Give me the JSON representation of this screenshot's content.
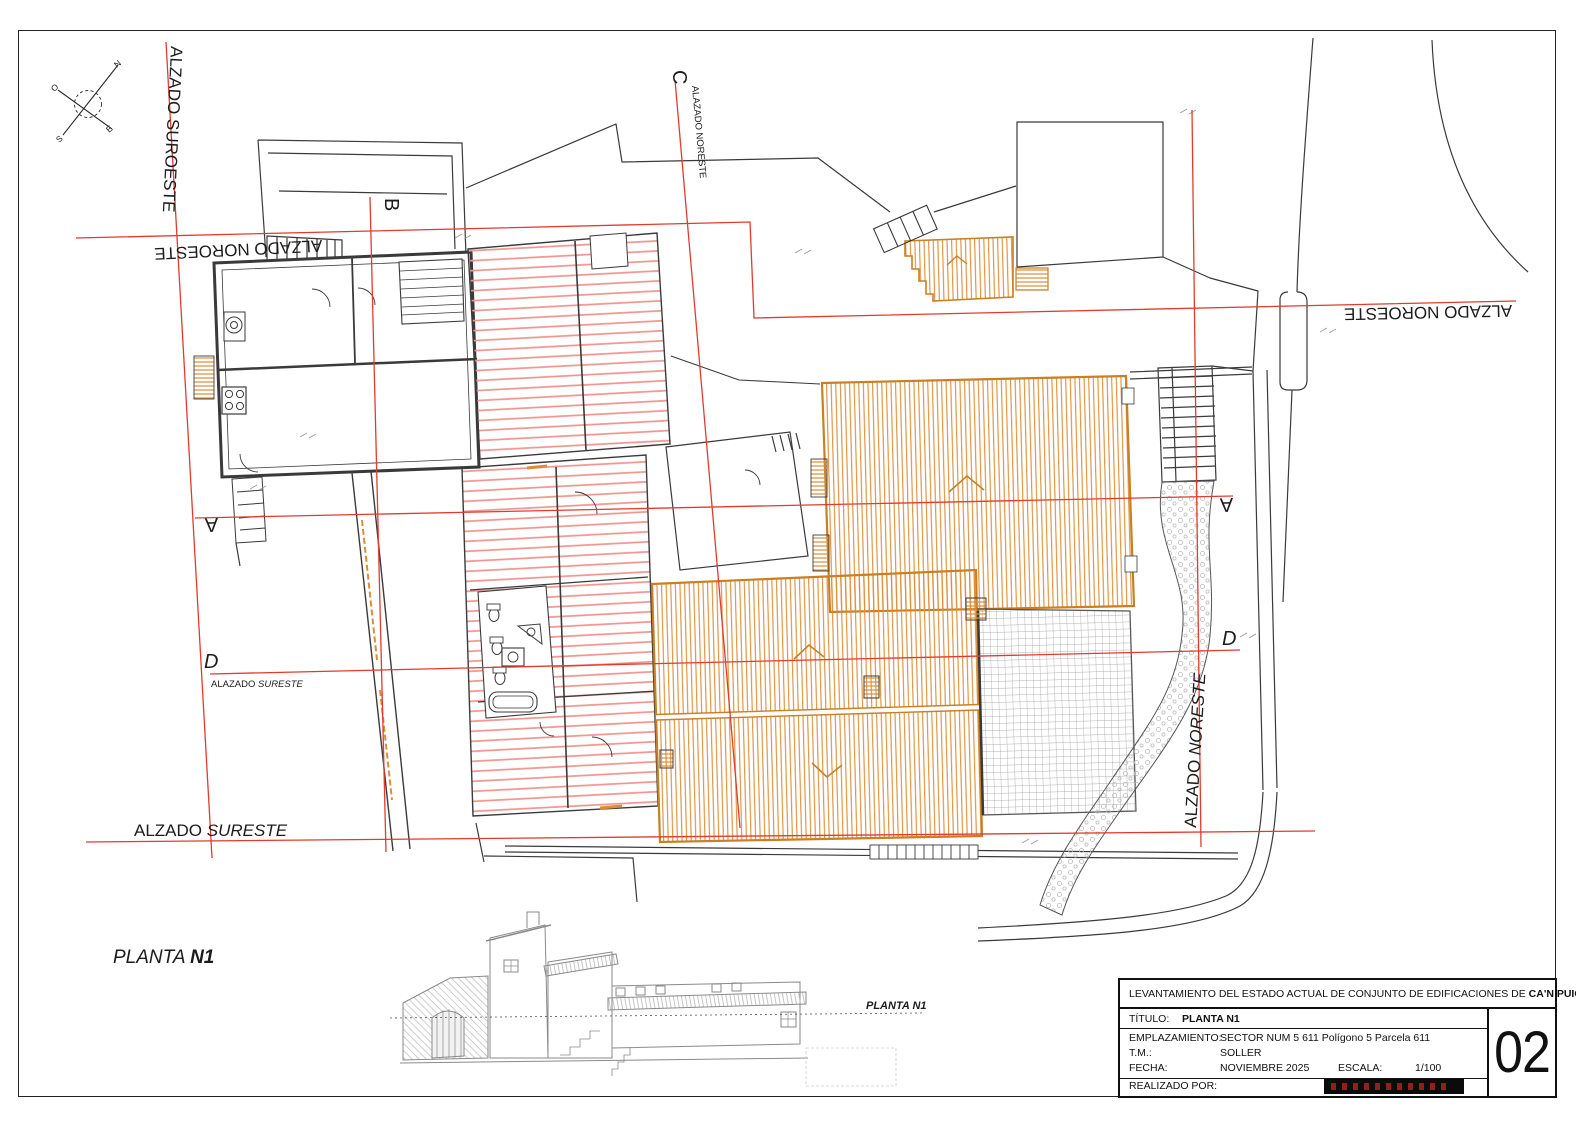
{
  "compass": {
    "n": "N",
    "s": "S",
    "e": "E",
    "o": "O"
  },
  "labels": {
    "suroeste": "ALZADO SUROESTE",
    "noroeste_left": "ALZADO NOROESTE",
    "noroeste_right": "ALZADO NOROESTE",
    "sureste_prefix": "ALZADO ",
    "sureste_italic": "SURESTE",
    "noreste_prefix": "ALZADO ",
    "noreste_italic": "NORESTE",
    "section_a_left": "A",
    "section_a_right": "A",
    "section_b": "B",
    "section_c": "C",
    "section_d_left": "D",
    "section_d_right": "D",
    "c_subtitle": "ALAZADO NORESTE",
    "d_subtitle_prefix": "ALAZADO ",
    "d_subtitle_italic": "SURESTE"
  },
  "plan_title": {
    "prefix": "PLANTA ",
    "bold": "N1"
  },
  "elevation_marker": {
    "prefix": "PLANTA ",
    "bold": "N1"
  },
  "title_block": {
    "header_prefix": "LEVANTAMIENTO DEL ESTADO ACTUAL DE CONJUNTO DE EDIFICACIONES DE ",
    "header_project": "CA'N PUIG",
    "titulo_label": "TÍTULO:",
    "titulo_value": "PLANTA N1",
    "emplazamiento_label": "EMPLAZAMIENTO:",
    "emplazamiento_value": "SECTOR NUM 5 611 Polígono 5 Parcela 611",
    "tm_label": "T.M.:",
    "tm_value": "SOLLER",
    "fecha_label": "FECHA:",
    "fecha_value": "NOVIEMBRE 2025",
    "escala_label": "ESCALA:",
    "escala_value": "1/100",
    "realizado_label": "REALIZADO POR:",
    "sheet_number": "02"
  },
  "colors": {
    "section_line_red": "#e23b2e",
    "roof_hatch_red": "#f0938d",
    "roof_orange": "#dd8d36",
    "roof_orange_border": "#c97f22",
    "linework": "#3a3a3a",
    "grid_gray": "#9a9a9a"
  }
}
